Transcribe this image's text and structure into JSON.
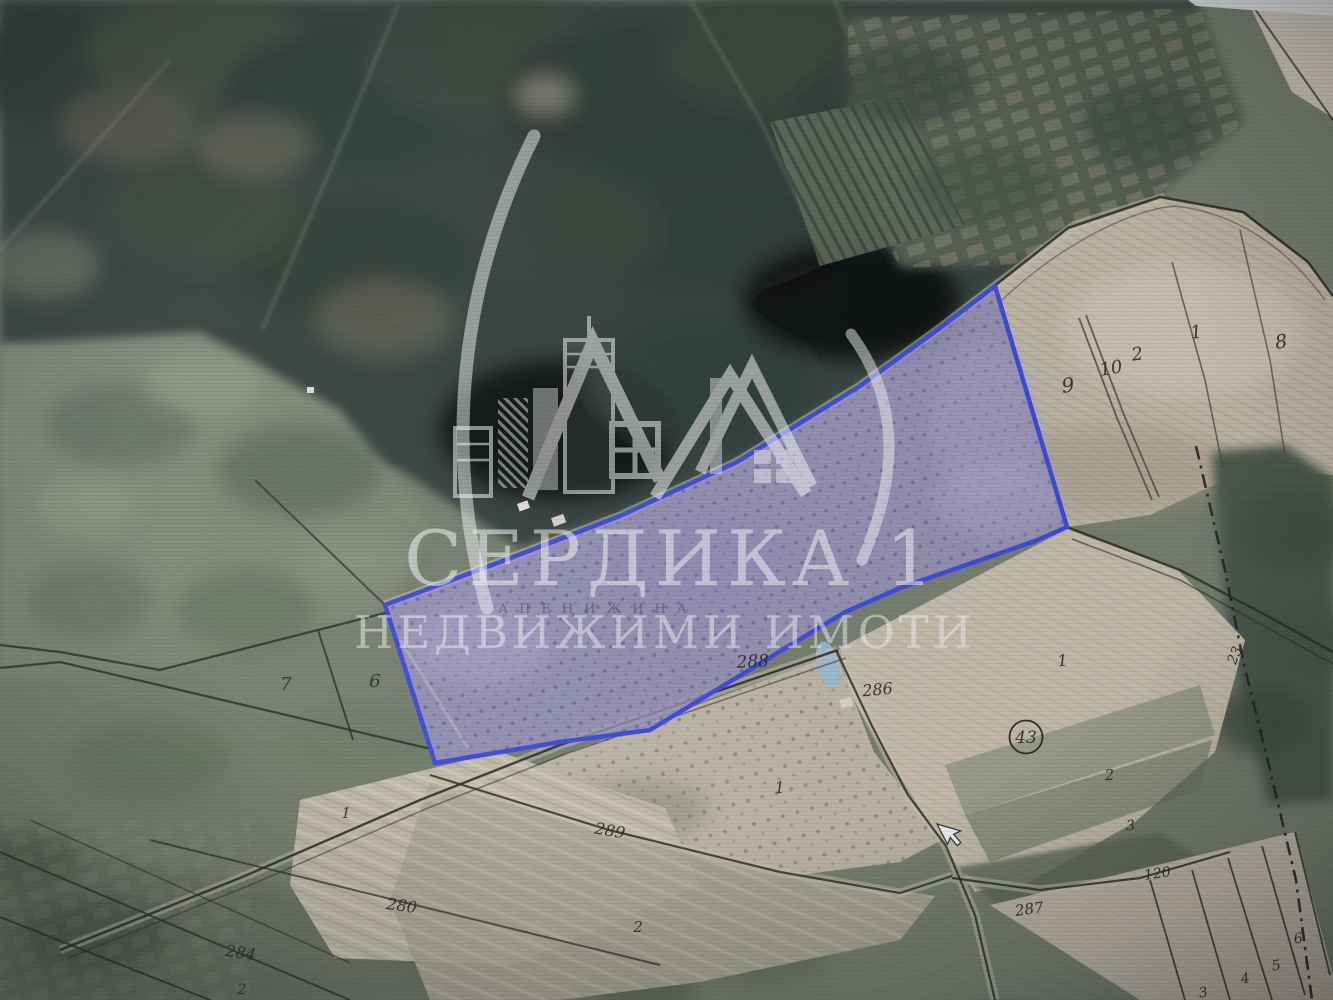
{
  "watermark": {
    "brand": "СЕРДИКА 1",
    "tagline": "НЕДВИЖИМИ ИМОТИ"
  },
  "map": {
    "locality_label": "АПЕНИЖИНА",
    "labels": {
      "p9": "9",
      "p10": "10",
      "p2_top": "2",
      "p1_top": "1",
      "p8": "8",
      "p7": "7",
      "p6": "6",
      "r288": "288",
      "r286": "286",
      "r289": "289",
      "r280": "280",
      "r284": "284",
      "r287": "287",
      "r120": "120",
      "p1_right": "1",
      "p43": "43",
      "p2_right": "2",
      "p3_right": "3",
      "p23": "23",
      "p1_center": "1",
      "p2_center": "2",
      "p1_left": "1",
      "p2_bl": "2",
      "s3": "3",
      "s4": "4",
      "s5": "5",
      "s6": "6"
    },
    "colors": {
      "highlight_fill": "#a29ac9",
      "highlight_border": "#3c4be2",
      "boundary_line": "#2b2b26",
      "field_beige": "#cbc1ae",
      "forest_dark": "#31403a"
    }
  }
}
